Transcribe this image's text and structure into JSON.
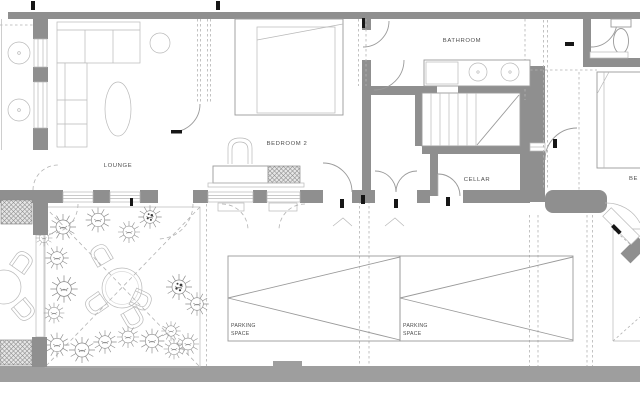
{
  "colors": {
    "background": "#ffffff",
    "wall": "#8f8f8f",
    "street": "#9e9e9e",
    "line": "#9a9a9a",
    "line_light": "#b9b9b9",
    "dash": "#b3b3b3",
    "text": "#4d4d4d",
    "tick": "#161616"
  },
  "labels": {
    "lounge": "LOUNGE",
    "bedroom2": "BEDROOM 2",
    "bathroom": "BATHROOM",
    "cellar": "CELLAR",
    "bedroom_right_partial": "BE",
    "parking_left": {
      "line1": "PARKING",
      "line2": "SPACE"
    },
    "parking_right": {
      "line1": "PARKING",
      "line2": "SPACE"
    }
  }
}
